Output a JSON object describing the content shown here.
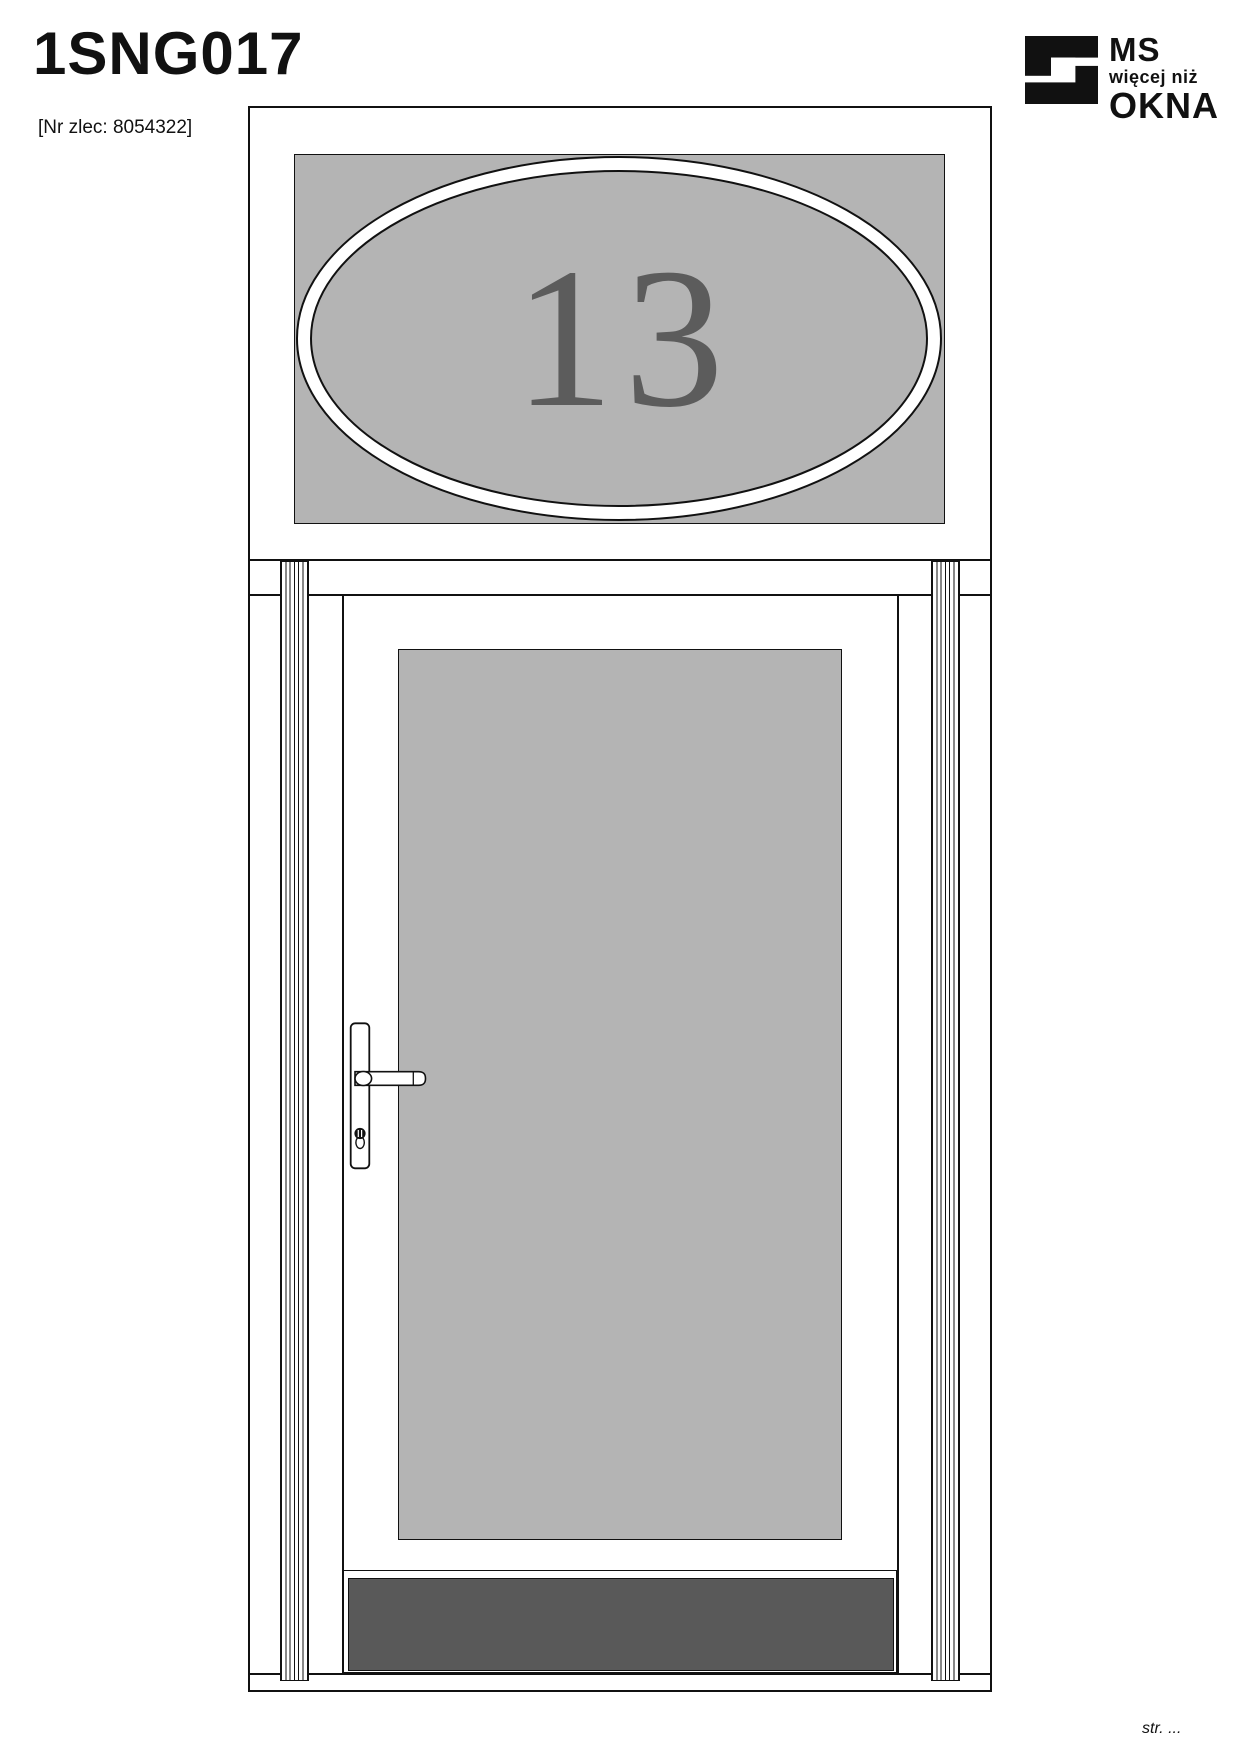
{
  "header": {
    "title": "1SNG017",
    "order_number": "[Nr zlec: 8054322]"
  },
  "logo": {
    "icon": "ms-okna-logo-icon",
    "line1": "MS",
    "line2": "więcej niż",
    "line3": "OKNA",
    "color": "#111111"
  },
  "drawing": {
    "type": "door-with-transom-elevation",
    "house_number": "13",
    "colors": {
      "glass": "#b4b4b4",
      "number": "#5c5c5c",
      "kick_panel": "#595959",
      "line": "#111111",
      "frame": "#ffffff"
    }
  },
  "footer": {
    "page_label": "str. ..."
  }
}
